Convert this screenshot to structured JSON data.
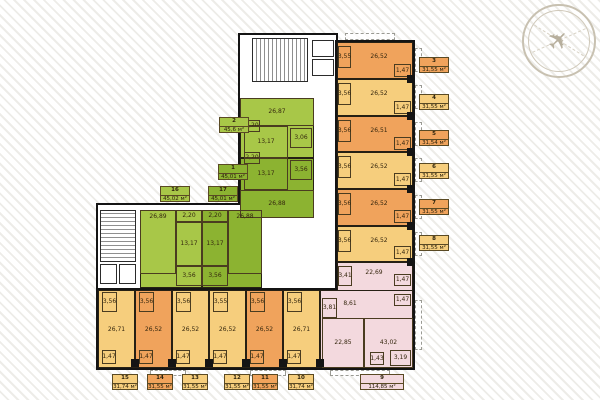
{
  "palette": {
    "o": "#F0A35C",
    "y": "#F6CE7D",
    "gl": "#A8C748",
    "gd": "#8CB331",
    "p": "#F3D9DE",
    "t": "transparent"
  },
  "compass": {
    "symbol": "✈"
  },
  "blocks": [
    {
      "x": 238,
      "y": 33,
      "w": 100,
      "h": 260
    },
    {
      "x": 96,
      "y": 203,
      "w": 146,
      "h": 90
    },
    {
      "x": 335,
      "y": 40,
      "w": 80,
      "h": 330
    },
    {
      "x": 96,
      "y": 288,
      "w": 319,
      "h": 82
    }
  ],
  "fills": [
    {
      "x": 337,
      "y": 42,
      "w": 76,
      "h": 37,
      "c": "o"
    },
    {
      "x": 337,
      "y": 79,
      "w": 76,
      "h": 37,
      "c": "y"
    },
    {
      "x": 337,
      "y": 116,
      "w": 76,
      "h": 36,
      "c": "o"
    },
    {
      "x": 337,
      "y": 152,
      "w": 76,
      "h": 37,
      "c": "y"
    },
    {
      "x": 337,
      "y": 189,
      "w": 76,
      "h": 37,
      "c": "o"
    },
    {
      "x": 337,
      "y": 226,
      "w": 76,
      "h": 36,
      "c": "y"
    },
    {
      "x": 337,
      "y": 262,
      "w": 76,
      "h": 106,
      "c": "p"
    },
    {
      "x": 320,
      "y": 290,
      "w": 93,
      "h": 78,
      "c": "p"
    },
    {
      "x": 98,
      "y": 290,
      "w": 37,
      "h": 78,
      "c": "y"
    },
    {
      "x": 135,
      "y": 290,
      "w": 37,
      "h": 78,
      "c": "o"
    },
    {
      "x": 172,
      "y": 290,
      "w": 37,
      "h": 78,
      "c": "y"
    },
    {
      "x": 209,
      "y": 290,
      "w": 37,
      "h": 78,
      "c": "y"
    },
    {
      "x": 246,
      "y": 290,
      "w": 37,
      "h": 78,
      "c": "o"
    },
    {
      "x": 283,
      "y": 290,
      "w": 37,
      "h": 78,
      "c": "y"
    },
    {
      "x": 240,
      "y": 98,
      "w": 74,
      "h": 60,
      "c": "gl"
    },
    {
      "x": 240,
      "y": 158,
      "w": 74,
      "h": 60,
      "c": "gd"
    },
    {
      "x": 140,
      "y": 210,
      "w": 62,
      "h": 78,
      "c": "gl"
    },
    {
      "x": 202,
      "y": 210,
      "w": 60,
      "h": 78,
      "c": "gd"
    }
  ],
  "rooms": [
    {
      "v": "3,55",
      "x": 338,
      "y": 46,
      "w": 13,
      "h": 22
    },
    {
      "v": "1,47",
      "x": 394,
      "y": 64,
      "w": 17,
      "h": 13
    },
    {
      "v": "26,52",
      "x": 350,
      "y": 46,
      "w": 58,
      "h": 22,
      "cls": "nb"
    },
    {
      "v": "3,56",
      "x": 338,
      "y": 83,
      "w": 13,
      "h": 22
    },
    {
      "v": "1,47",
      "x": 394,
      "y": 101,
      "w": 17,
      "h": 13
    },
    {
      "v": "26,52",
      "x": 350,
      "y": 83,
      "w": 58,
      "h": 22,
      "cls": "nb"
    },
    {
      "v": "3,56",
      "x": 338,
      "y": 120,
      "w": 13,
      "h": 22
    },
    {
      "v": "1,47",
      "x": 394,
      "y": 137,
      "w": 17,
      "h": 13
    },
    {
      "v": "26,51",
      "x": 350,
      "y": 120,
      "w": 58,
      "h": 22,
      "cls": "nb"
    },
    {
      "v": "3,56",
      "x": 338,
      "y": 156,
      "w": 13,
      "h": 22
    },
    {
      "v": "1,47",
      "x": 394,
      "y": 173,
      "w": 17,
      "h": 13
    },
    {
      "v": "26,52",
      "x": 350,
      "y": 156,
      "w": 58,
      "h": 22,
      "cls": "nb"
    },
    {
      "v": "3,56",
      "x": 338,
      "y": 193,
      "w": 13,
      "h": 22
    },
    {
      "v": "1,47",
      "x": 394,
      "y": 210,
      "w": 17,
      "h": 13
    },
    {
      "v": "26,52",
      "x": 350,
      "y": 193,
      "w": 58,
      "h": 22,
      "cls": "nb"
    },
    {
      "v": "3,56",
      "x": 338,
      "y": 230,
      "w": 13,
      "h": 22
    },
    {
      "v": "1,47",
      "x": 394,
      "y": 246,
      "w": 17,
      "h": 13
    },
    {
      "v": "26,52",
      "x": 350,
      "y": 230,
      "w": 58,
      "h": 22,
      "cls": "nb"
    },
    {
      "v": "3,41",
      "x": 338,
      "y": 266,
      "w": 14,
      "h": 20
    },
    {
      "v": "22,69",
      "x": 352,
      "y": 266,
      "w": 44,
      "h": 14,
      "cls": "nb"
    },
    {
      "v": "1,47",
      "x": 394,
      "y": 274,
      "w": 17,
      "h": 12
    },
    {
      "v": "1,47",
      "x": 394,
      "y": 294,
      "w": 17,
      "h": 12
    },
    {
      "v": "8,61",
      "x": 339,
      "y": 298,
      "w": 22,
      "h": 12,
      "cls": "nb"
    },
    {
      "v": "3,81",
      "x": 322,
      "y": 298,
      "w": 15,
      "h": 20
    },
    {
      "v": "22,85",
      "x": 322,
      "y": 318,
      "w": 42,
      "h": 50
    },
    {
      "v": "43,02",
      "x": 364,
      "y": 318,
      "w": 49,
      "h": 50
    },
    {
      "v": "1,43",
      "x": 370,
      "y": 352,
      "w": 14,
      "h": 13
    },
    {
      "v": "3,19",
      "x": 390,
      "y": 350,
      "w": 21,
      "h": 16
    },
    {
      "v": "3,56",
      "x": 102,
      "y": 292,
      "w": 15,
      "h": 20
    },
    {
      "v": "1,47",
      "x": 102,
      "y": 350,
      "w": 14,
      "h": 14
    },
    {
      "v": "26,71",
      "x": 100,
      "y": 322,
      "w": 33,
      "h": 16,
      "cls": "nb"
    },
    {
      "v": "3,56",
      "x": 139,
      "y": 292,
      "w": 15,
      "h": 20
    },
    {
      "v": "1,47",
      "x": 139,
      "y": 350,
      "w": 14,
      "h": 14
    },
    {
      "v": "26,52",
      "x": 137,
      "y": 322,
      "w": 33,
      "h": 16,
      "cls": "nb"
    },
    {
      "v": "3,56",
      "x": 176,
      "y": 292,
      "w": 15,
      "h": 20
    },
    {
      "v": "1,47",
      "x": 176,
      "y": 350,
      "w": 14,
      "h": 14
    },
    {
      "v": "26,52",
      "x": 174,
      "y": 322,
      "w": 33,
      "h": 16,
      "cls": "nb"
    },
    {
      "v": "3,55",
      "x": 213,
      "y": 292,
      "w": 15,
      "h": 20
    },
    {
      "v": "1,47",
      "x": 213,
      "y": 350,
      "w": 14,
      "h": 14
    },
    {
      "v": "26,52",
      "x": 211,
      "y": 322,
      "w": 33,
      "h": 16,
      "cls": "nb"
    },
    {
      "v": "3,56",
      "x": 250,
      "y": 292,
      "w": 15,
      "h": 20
    },
    {
      "v": "1,47",
      "x": 250,
      "y": 350,
      "w": 14,
      "h": 14
    },
    {
      "v": "26,52",
      "x": 248,
      "y": 322,
      "w": 33,
      "h": 16,
      "cls": "nb"
    },
    {
      "v": "3,56",
      "x": 287,
      "y": 292,
      "w": 15,
      "h": 20
    },
    {
      "v": "1,47",
      "x": 287,
      "y": 350,
      "w": 14,
      "h": 14
    },
    {
      "v": "26,71",
      "x": 285,
      "y": 322,
      "w": 33,
      "h": 16,
      "cls": "nb"
    },
    {
      "v": "26,87",
      "x": 240,
      "y": 98,
      "w": 74,
      "h": 28
    },
    {
      "v": "2,20",
      "x": 244,
      "y": 120,
      "w": 16,
      "h": 12
    },
    {
      "v": "13,17",
      "x": 244,
      "y": 126,
      "w": 44,
      "h": 32
    },
    {
      "v": "3,06",
      "x": 290,
      "y": 128,
      "w": 22,
      "h": 20
    },
    {
      "v": "2,20",
      "x": 244,
      "y": 152,
      "w": 16,
      "h": 12
    },
    {
      "v": "13,17",
      "x": 244,
      "y": 158,
      "w": 44,
      "h": 32
    },
    {
      "v": "3,56",
      "x": 290,
      "y": 160,
      "w": 22,
      "h": 20
    },
    {
      "v": "26,88",
      "x": 240,
      "y": 190,
      "w": 74,
      "h": 28
    },
    {
      "v": "26,89",
      "x": 140,
      "y": 210,
      "w": 36,
      "h": 64,
      "cls": "vt"
    },
    {
      "v": "2,20",
      "x": 176,
      "y": 210,
      "w": 26,
      "h": 12
    },
    {
      "v": "13,17",
      "x": 176,
      "y": 222,
      "w": 26,
      "h": 44
    },
    {
      "v": "3,56",
      "x": 176,
      "y": 266,
      "w": 26,
      "h": 20
    },
    {
      "v": "2,20",
      "x": 202,
      "y": 210,
      "w": 26,
      "h": 12
    },
    {
      "v": "13,17",
      "x": 202,
      "y": 222,
      "w": 26,
      "h": 44
    },
    {
      "v": "3,56",
      "x": 202,
      "y": 266,
      "w": 26,
      "h": 20
    },
    {
      "v": "26,88",
      "x": 228,
      "y": 210,
      "w": 34,
      "h": 64,
      "cls": "vt"
    }
  ],
  "labels": [
    {
      "n": "1",
      "a": "45,01 м²",
      "x": 218,
      "y": 164,
      "w": 30,
      "c": "gd"
    },
    {
      "n": "2",
      "a": "45,6 м²",
      "x": 219,
      "y": 117,
      "w": 30,
      "c": "gl"
    },
    {
      "n": "3",
      "a": "31,55 м²",
      "x": 419,
      "y": 57,
      "w": 30,
      "c": "o"
    },
    {
      "n": "4",
      "a": "31,55 м²",
      "x": 419,
      "y": 94,
      "w": 30,
      "c": "y"
    },
    {
      "n": "5",
      "a": "31,54 м²",
      "x": 419,
      "y": 130,
      "w": 30,
      "c": "o"
    },
    {
      "n": "6",
      "a": "31,55 м²",
      "x": 419,
      "y": 163,
      "w": 30,
      "c": "y"
    },
    {
      "n": "7",
      "a": "31,55 м²",
      "x": 419,
      "y": 199,
      "w": 30,
      "c": "o"
    },
    {
      "n": "8",
      "a": "31,55 м²",
      "x": 419,
      "y": 235,
      "w": 30,
      "c": "y"
    },
    {
      "n": "9",
      "a": "114,85 м²",
      "x": 360,
      "y": 374,
      "w": 44,
      "c": "p"
    },
    {
      "n": "10",
      "a": "31,74 м²",
      "x": 288,
      "y": 374,
      "w": 26,
      "c": "y"
    },
    {
      "n": "11",
      "a": "31,55 м²",
      "x": 252,
      "y": 374,
      "w": 26,
      "c": "o"
    },
    {
      "n": "12",
      "a": "31,55 м²",
      "x": 224,
      "y": 374,
      "w": 26,
      "c": "y"
    },
    {
      "n": "13",
      "a": "31,55 м²",
      "x": 182,
      "y": 374,
      "w": 26,
      "c": "y"
    },
    {
      "n": "14",
      "a": "31,55 м²",
      "x": 147,
      "y": 374,
      "w": 26,
      "c": "o"
    },
    {
      "n": "15",
      "a": "31,74 м²",
      "x": 112,
      "y": 374,
      "w": 26,
      "c": "y"
    },
    {
      "n": "16",
      "a": "45,02 м²",
      "x": 160,
      "y": 186,
      "w": 30,
      "c": "gl"
    },
    {
      "n": "17",
      "a": "45,01 м²",
      "x": 208,
      "y": 186,
      "w": 30,
      "c": "gd"
    }
  ],
  "stairs": [
    {
      "x": 252,
      "y": 38,
      "w": 56,
      "h": 44,
      "dir": "h"
    },
    {
      "x": 100,
      "y": 210,
      "w": 36,
      "h": 52,
      "dir": "v"
    }
  ],
  "elevators": [
    {
      "x": 312,
      "y": 40,
      "w": 22,
      "h": 17
    },
    {
      "x": 312,
      "y": 59,
      "w": 22,
      "h": 17
    },
    {
      "x": 100,
      "y": 264,
      "w": 17,
      "h": 20
    },
    {
      "x": 119,
      "y": 264,
      "w": 17,
      "h": 20
    }
  ],
  "piers": [
    {
      "x": 407,
      "y": 75,
      "w": 8,
      "h": 8
    },
    {
      "x": 407,
      "y": 112,
      "w": 8,
      "h": 8
    },
    {
      "x": 407,
      "y": 148,
      "w": 8,
      "h": 8
    },
    {
      "x": 407,
      "y": 185,
      "w": 8,
      "h": 8
    },
    {
      "x": 407,
      "y": 222,
      "w": 8,
      "h": 8
    },
    {
      "x": 407,
      "y": 258,
      "w": 8,
      "h": 8
    },
    {
      "x": 131,
      "y": 359,
      "w": 8,
      "h": 8
    },
    {
      "x": 168,
      "y": 359,
      "w": 8,
      "h": 8
    },
    {
      "x": 205,
      "y": 359,
      "w": 8,
      "h": 8
    },
    {
      "x": 242,
      "y": 359,
      "w": 8,
      "h": 8
    },
    {
      "x": 279,
      "y": 359,
      "w": 8,
      "h": 8
    },
    {
      "x": 316,
      "y": 359,
      "w": 8,
      "h": 8
    }
  ],
  "balconies": [
    {
      "x": 345,
      "y": 33,
      "w": 50,
      "h": 7
    },
    {
      "x": 415,
      "y": 48,
      "w": 7,
      "h": 24
    },
    {
      "x": 415,
      "y": 85,
      "w": 7,
      "h": 24
    },
    {
      "x": 415,
      "y": 122,
      "w": 7,
      "h": 24
    },
    {
      "x": 415,
      "y": 158,
      "w": 7,
      "h": 24
    },
    {
      "x": 415,
      "y": 195,
      "w": 7,
      "h": 24
    },
    {
      "x": 415,
      "y": 232,
      "w": 7,
      "h": 24
    },
    {
      "x": 415,
      "y": 300,
      "w": 7,
      "h": 50
    },
    {
      "x": 150,
      "y": 370,
      "w": 36,
      "h": 6
    },
    {
      "x": 250,
      "y": 370,
      "w": 36,
      "h": 6
    },
    {
      "x": 330,
      "y": 370,
      "w": 60,
      "h": 6
    }
  ]
}
